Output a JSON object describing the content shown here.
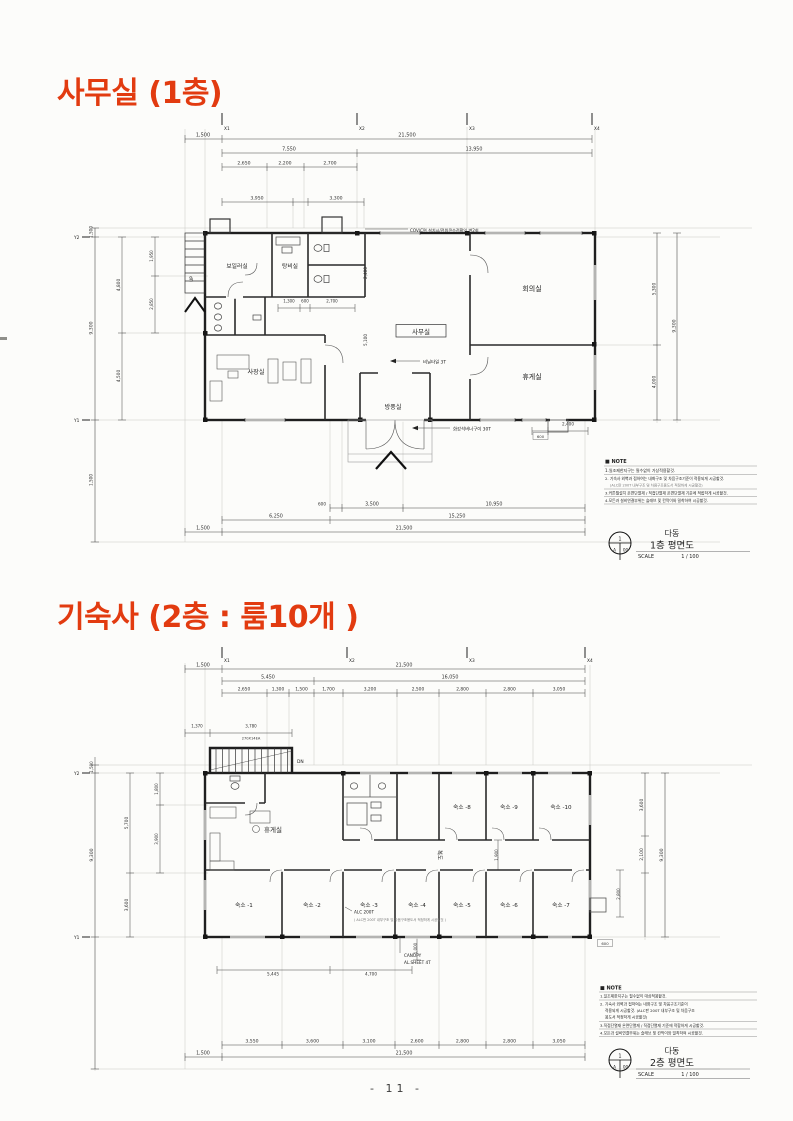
{
  "page": {
    "number": "- 11 -"
  },
  "p1": {
    "title": "사무실 (1층)",
    "grid_x": [
      "X1",
      "X2",
      "X3",
      "X4"
    ],
    "grid_y": [
      "Y2",
      "Y1"
    ],
    "d": {
      "t1": [
        "1,500",
        "21,500"
      ],
      "t2": [
        "7,550",
        "13,950"
      ],
      "t3": [
        "2,650",
        "2,200",
        "2,700"
      ],
      "t4": [
        "3,950",
        "3,300"
      ],
      "b1": [
        "600",
        "3,500",
        "10,950"
      ],
      "b2": [
        "6,250",
        "15,250"
      ],
      "b3": [
        "1,500",
        "21,500"
      ],
      "left": [
        "1,500",
        "9,300",
        "1,500",
        "4,800",
        "4,500",
        "1,950",
        "2,850"
      ],
      "right": [
        "5,300",
        "4,000",
        "9,300"
      ],
      "inner": [
        "1,300",
        "600",
        "2,700",
        "2,400",
        "5,100",
        "600",
        "2,400"
      ]
    },
    "rooms": {
      "boiler": "보일러실",
      "pantry": "탕비실",
      "office": "사무실",
      "meeting": "회의실",
      "rest": "휴게실",
      "ceo": "사장실",
      "wind": "방풍실"
    },
    "ann": {
      "up": "UP",
      "power": "COV/C면 설치시/전원콘수전확인 변2회",
      "vinyl": "비닐타일 3T",
      "granite": "화강석버너구이 30T"
    },
    "note": {
      "title": "■ NOTE",
      "l1": "1.일조제한지구는 필수없이 가상적용할것.",
      "l2": "2. 기숙사 외벽과 접하여는 내화구조 및 차음구조기준이 적용되게 시공할것.",
      "l3": "(ALC판 200T 내부구조 및 차음구조용도서 적정하게 시공할것)",
      "l4": "3.커튼월설치 온면단열재 / 직접단열재 온면단열재 기준에 적합하게 시공할것.",
      "l5": "4.모든과 설비연결부위는 슬래브 및 칸막이와 밀착하여 시공할것."
    },
    "tb": {
      "bld": "다동",
      "name": "1층 평면도",
      "scale": "SCALE",
      "ratio": "1 / 100",
      "s1": "1",
      "s2": "A",
      "s3": "00"
    }
  },
  "p2": {
    "title": "기숙사 (2층 : 룸10개 )",
    "grid_x": [
      "X1",
      "X2",
      "X3",
      "X4"
    ],
    "grid_y": [
      "Y2",
      "Y1"
    ],
    "d": {
      "t1": [
        "1,500",
        "21,500"
      ],
      "t2": [
        "5,450",
        "16,050"
      ],
      "t3": [
        "2,650",
        "1,300",
        "1,500",
        "1,700",
        "3,200",
        "2,500",
        "2,800",
        "2,800",
        "3,050"
      ],
      "b1": [
        "3,550",
        "3,600",
        "3,100",
        "2,600",
        "2,800",
        "2,800",
        "3,050"
      ],
      "b2": [
        "1,500",
        "21,500"
      ],
      "left": [
        "1,500",
        "9,300",
        "5,700",
        "3,600",
        "1,800",
        "3,900"
      ],
      "right": [
        "3,600",
        "2,100",
        "9,300",
        "2,800",
        "600"
      ],
      "stair": [
        "1,370",
        "3,780",
        "270X14EA"
      ],
      "canopy": [
        "5,445",
        "4,700",
        "1,000"
      ],
      "inner": [
        "1,900"
      ]
    },
    "rooms": {
      "rest": "휴게실",
      "corridor": "복도",
      "u1": "숙소 -1",
      "u2": "숙소 -2",
      "u3": "숙소 -3",
      "u4": "숙소 -4",
      "u5": "숙소 -5",
      "u6": "숙소 -6",
      "u7": "숙소 -7",
      "u8": "숙소 -8",
      "u9": "숙소 -9",
      "u10": "숙소 -10"
    },
    "ann": {
      "dn": "DN",
      "alc": "ALC 200T",
      "alc2": "( ALC판 200T 내부구조 및 차음구조용도서 적정하게 시공할것 )",
      "c1": "CANOPY",
      "c2": "AL.SHEET 4T"
    },
    "note": {
      "title": "■ NOTE",
      "l1": "1.일조제한지구는 필수없이 대상적용할것.",
      "l2": "2. 기숙사 외벽과 접하여는 내화구조 및 차음구조기준이",
      "l3": "적용되게 시공할것. (ALC판 200T 내부구조 및 차음구조",
      "l4": "용도서 적정하게 시공할것)",
      "l5": "3.직접단열재 온면단열재 / 직접단열재 기준에 적합하게 시공할것.",
      "l6": "4.모든과 설비연결부위는 슬래브 및 칸막이와 밀착하여 시공할것."
    },
    "tb": {
      "bld": "다동",
      "name": "2층 평면도",
      "scale": "SCALE",
      "ratio": "1 / 100",
      "s1": "1",
      "s2": "A",
      "s3": "00"
    }
  }
}
